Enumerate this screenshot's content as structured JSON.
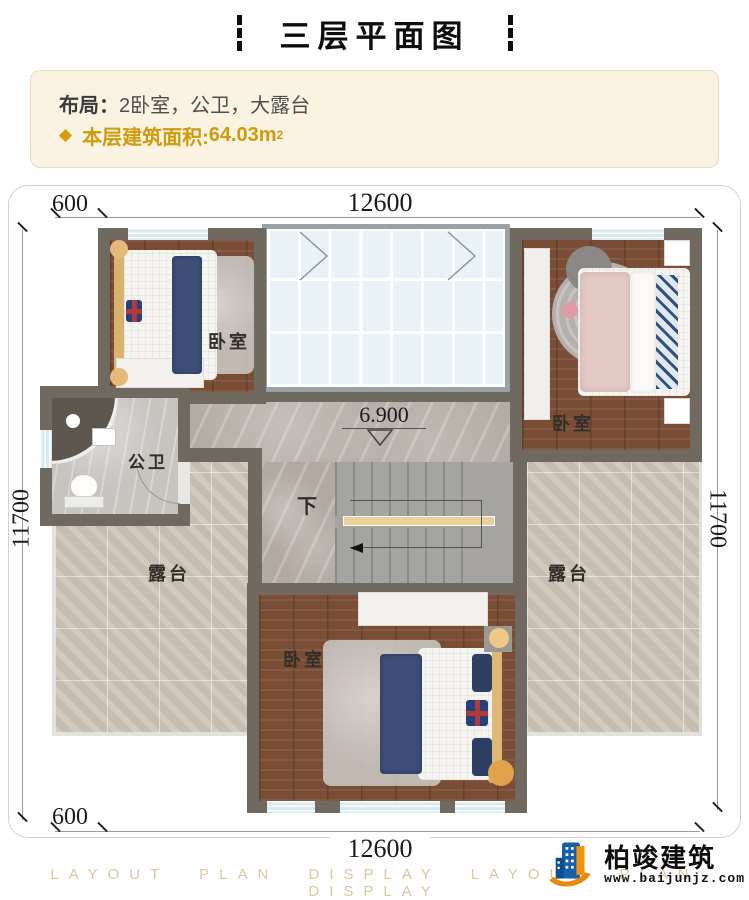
{
  "header": {
    "title": "三层平面图"
  },
  "info": {
    "layout_label": "布局：",
    "layout_value": "2卧室，公卫，大露台",
    "bullet": "◆",
    "area_label": "本层建筑面积:",
    "area_value": "64.03m",
    "area_sup": "2",
    "accent_color": "#cf9a0c"
  },
  "plan": {
    "dims": {
      "top_offset": "600",
      "top_width": "12600",
      "bottom_offset": "600",
      "bottom_width": "12600",
      "left_height": "11700",
      "right_height": "11700"
    },
    "rooms": {
      "bedroom_top_left": "卧室",
      "bedroom_top_right": "卧室",
      "bedroom_bottom": "卧室",
      "bathroom": "公卫",
      "terrace_left": "露台",
      "terrace_right": "露台"
    },
    "stairs": {
      "down_label": "下"
    },
    "elevation": "6.900",
    "wall_color": "#6f695f"
  },
  "footer": {
    "brand_name": "柏竣建筑",
    "brand_site": "www.baijunjz.com",
    "watermark": "LAYOUT PLAN DISPLAY LAYOUT PLAN DISPLAY"
  }
}
